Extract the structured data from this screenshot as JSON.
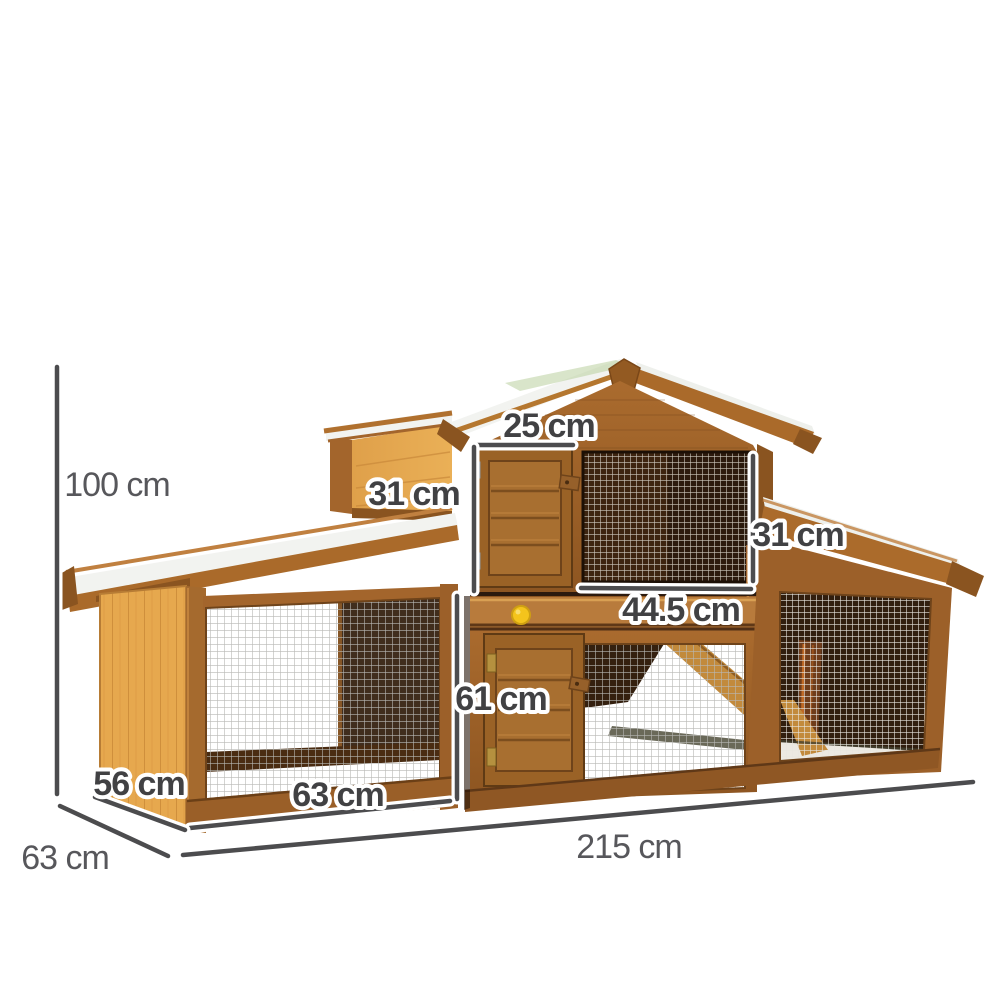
{
  "page": {
    "background": "#ffffff",
    "description": "Product dimension diagram of a two-storey wooden pet hutch (rabbit hutch / chicken coop) with asymmetric gabled roof, two slatted wooden doors, wire mesh runs, interior ramp and dimension annotations."
  },
  "dimension_style": {
    "line_color": "#4c4c4e",
    "halo_color": "#ffffff",
    "text_color_plain": "#57575b",
    "text_color_outlined": "#414143"
  },
  "dimensions": {
    "total_height": {
      "label": "100 cm"
    },
    "upper_door_width": {
      "label": "25 cm"
    },
    "upper_door_height": {
      "label": "31 cm"
    },
    "upper_window_height": {
      "label": "31 cm"
    },
    "upper_window_width": {
      "label": "44.5 cm"
    },
    "lower_door_height": {
      "label": "61 cm"
    },
    "left_run_width": {
      "label": "63 cm"
    },
    "left_box_depth": {
      "label": "56 cm"
    },
    "overall_depth": {
      "label": "63 cm"
    },
    "overall_width": {
      "label": "215 cm"
    }
  },
  "hutch": {
    "palette": {
      "wood_mid": "#a3652c",
      "wood_dark": "#8a5420",
      "wood_deep": "#6e431a",
      "wood_light": "#e6a84e",
      "wood_frame": "#9c6029",
      "roof_white": "#f2f3f0",
      "skylight_green": "#b9cf9f",
      "interior_dark": "#311e0e",
      "mesh_light": "#bdbdb9",
      "mesh_bright": "#e8e6e0",
      "knob_yellow": "#f4c41c",
      "hinge_silver": "#c9ced3",
      "hinge_brass": "#b5913f",
      "ramp_wood": "#c28a3c"
    }
  }
}
